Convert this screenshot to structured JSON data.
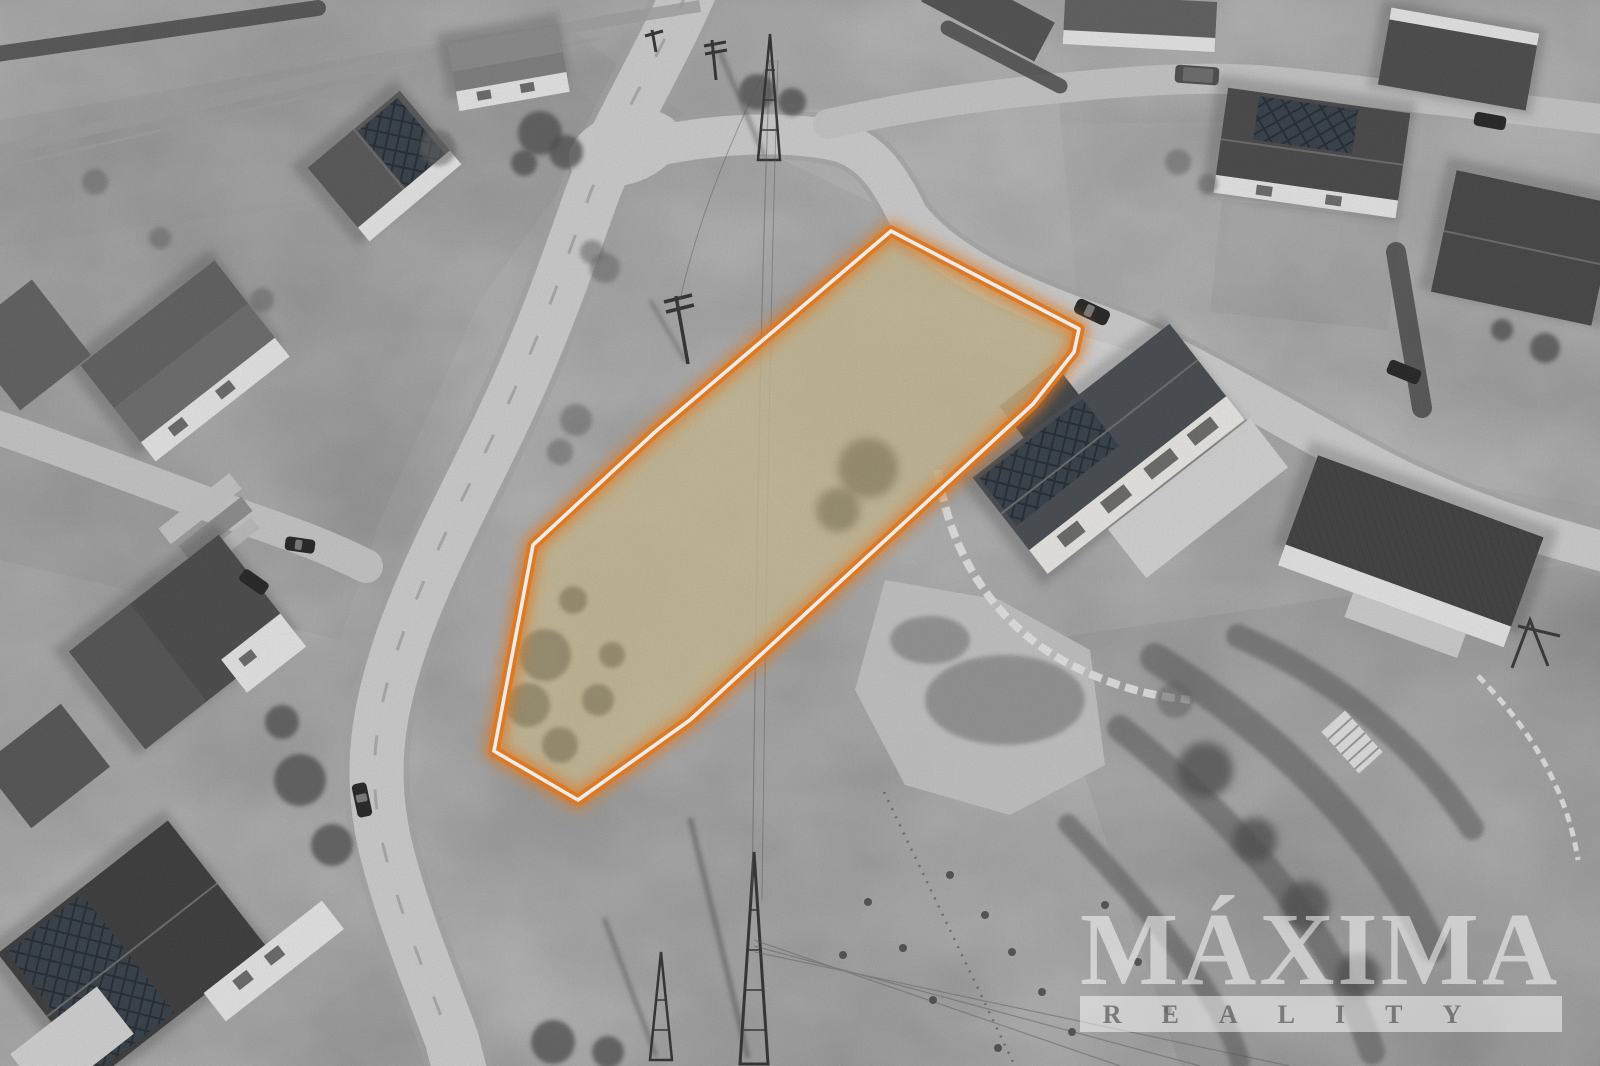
{
  "watermark": {
    "title": "MÁXIMA",
    "subtitle": "REALITY"
  },
  "plot": {
    "points": "891,231 1079,329 1074,352 1033,404 690,720 578,800 494,751 533,545 655,432",
    "outline_color": "#f07d1a",
    "inner_line_color": "#ffffff",
    "fill_color": "#cdbd93"
  },
  "palette": {
    "ground": "#b5b5b5",
    "road": "#cfcfcf",
    "roof_dark": "#3f3f3f",
    "wall_light": "#e9e9e9",
    "solar_panel": "#323c46",
    "watermark_white": "rgba(255,255,255,0.5)"
  }
}
